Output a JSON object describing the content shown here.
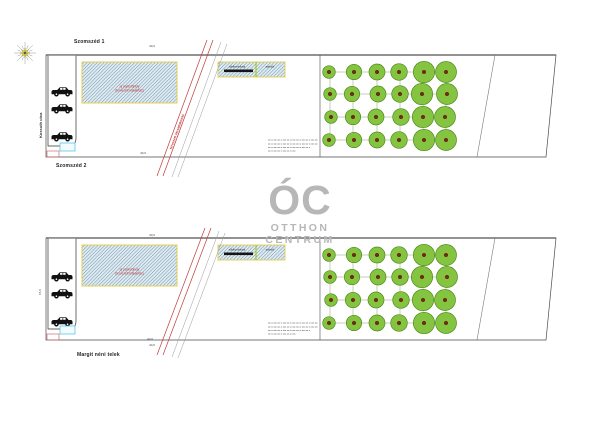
{
  "watermark": {
    "monogram": "ÓC",
    "line1": "OTTHON",
    "line2": "CENTRUM",
    "color": "#b7b7b7"
  },
  "captions": {
    "neighbor_top": "Szomszéd 1",
    "neighbor_bottom": "Szomszéd 2",
    "site_caption": "Margit néni telek",
    "street_vertical": "Kossuth utca",
    "road_label": "tervezett útcsatlakozás"
  },
  "annotations": {
    "big_hatch_line1": "új parkolóhely",
    "big_hatch_line2": "(tervezett kialakítás)",
    "small_hatch_left": "zöldhomlokzat",
    "small_hatch_right": "parkoló",
    "dim_horizontal": "40,0",
    "dim_vertical": "15,0"
  },
  "colors": {
    "parcel_stroke": "#4a4a4a",
    "parcel_top_edge": "#6f6f6f",
    "hatch_fill": "#dcecf5",
    "hatch_line": "#4a5e70",
    "hatch_border": "#e3cf4e",
    "divider": "#a8c800",
    "road_red": "#c23a3a",
    "road_gray": "#9a9a9a",
    "tree_fill": "#85c440",
    "tree_stroke": "#4f8a1d",
    "tree_core": "#7a2a12",
    "grid_line": "#8aa06a",
    "car": "#111111",
    "legend_cyan": "#59c8e8",
    "legend_red": "#d06868",
    "notes_line": "#888888",
    "text_red": "#c23a3a",
    "text_dark": "#333333",
    "compass_star": "#d4cf3a",
    "compass_spoke": "#999999"
  },
  "geometry": {
    "parcel": {
      "x1": 46,
      "x2_top": 556,
      "x2_bot": 546,
      "h": 102
    },
    "divider_x": 320,
    "slant": {
      "x_top": 495,
      "x_bot": 477
    },
    "strip": {
      "x1": 48,
      "x2": 76,
      "h": 91
    },
    "big_hatch": {
      "x": 82,
      "y_off": 7,
      "w": 95,
      "h": 41
    },
    "small_hatch": {
      "x": 218,
      "y_off": 7,
      "w": 67,
      "h": 15,
      "divider_x": 256,
      "bar": {
        "x": 224,
        "y_off": 14.5,
        "w": 29,
        "h": 2.6
      }
    },
    "legend_cyan": {
      "x": 60,
      "y_off": 88,
      "w": 15,
      "h": 8
    },
    "legend_red": {
      "x": 47,
      "y_off": 96,
      "w": 12,
      "h": 6
    },
    "notes": {
      "x": 268,
      "widths": [
        50,
        50,
        42,
        28
      ],
      "y_offs": [
        85,
        89,
        92.5,
        96
      ]
    },
    "trees": {
      "col_x": [
        330,
        353,
        377,
        400,
        423,
        446
      ],
      "row_offs": [
        17,
        39,
        62,
        85
      ],
      "col_r": [
        7,
        7,
        8,
        9,
        10,
        10.5
      ]
    },
    "plans": [
      {
        "name": "site-plan-top",
        "y0": 55,
        "car_offs": [
          37,
          54,
          82
        ],
        "road_label": true,
        "roads": [
          {
            "x1": 207,
            "y1": 40,
            "x2": 157,
            "y2": 176,
            "c": "red"
          },
          {
            "x1": 213,
            "y1": 40,
            "x2": 163,
            "y2": 176,
            "c": "red"
          },
          {
            "x1": 221,
            "y1": 42,
            "x2": 172,
            "y2": 177,
            "c": "gray"
          },
          {
            "x1": 227,
            "y1": 44,
            "x2": 178,
            "y2": 177,
            "c": "gray"
          }
        ],
        "dims": [
          {
            "x": 152,
            "y": 47
          },
          {
            "x": 143,
            "y": 154
          }
        ]
      },
      {
        "name": "site-plan-bottom",
        "y0": 238,
        "car_offs": [
          39,
          56,
          84
        ],
        "road_label": false,
        "roads": [
          {
            "x1": 205,
            "y1": 228,
            "x2": 157,
            "y2": 355,
            "c": "red"
          },
          {
            "x1": 211,
            "y1": 228,
            "x2": 163,
            "y2": 355,
            "c": "red"
          },
          {
            "x1": 219,
            "y1": 231,
            "x2": 172,
            "y2": 357,
            "c": "gray"
          },
          {
            "x1": 225,
            "y1": 233,
            "x2": 178,
            "y2": 358,
            "c": "gray"
          }
        ],
        "dims": [
          {
            "x": 152,
            "y": 236
          },
          {
            "x": 150,
            "y": 340
          },
          {
            "x": 152,
            "y": 346
          }
        ]
      }
    ]
  }
}
